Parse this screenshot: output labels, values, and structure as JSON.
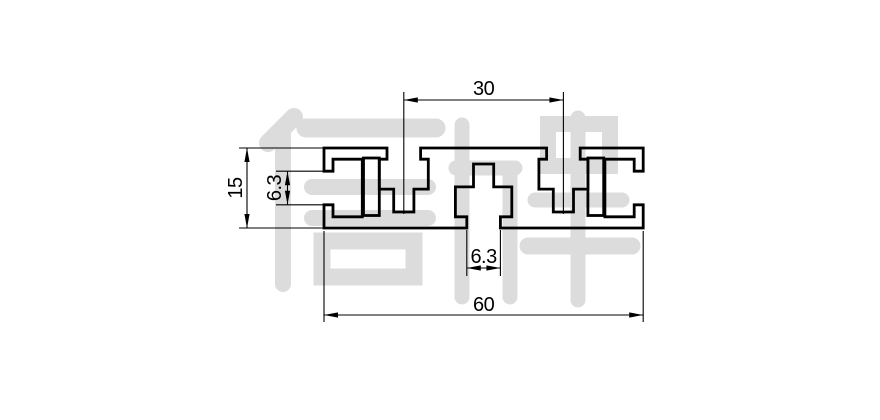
{
  "drawing": {
    "type": "extrusion-profile-cross-section",
    "watermark_text": "信牌",
    "colors": {
      "line": "#000000",
      "watermark": "#dcdcdc",
      "background": "#ffffff"
    },
    "dimensions": {
      "top_slot_pitch": "30",
      "profile_height": "15",
      "side_slot_opening": "6.3",
      "bottom_slot_opening": "6.3",
      "profile_width": "60"
    }
  }
}
